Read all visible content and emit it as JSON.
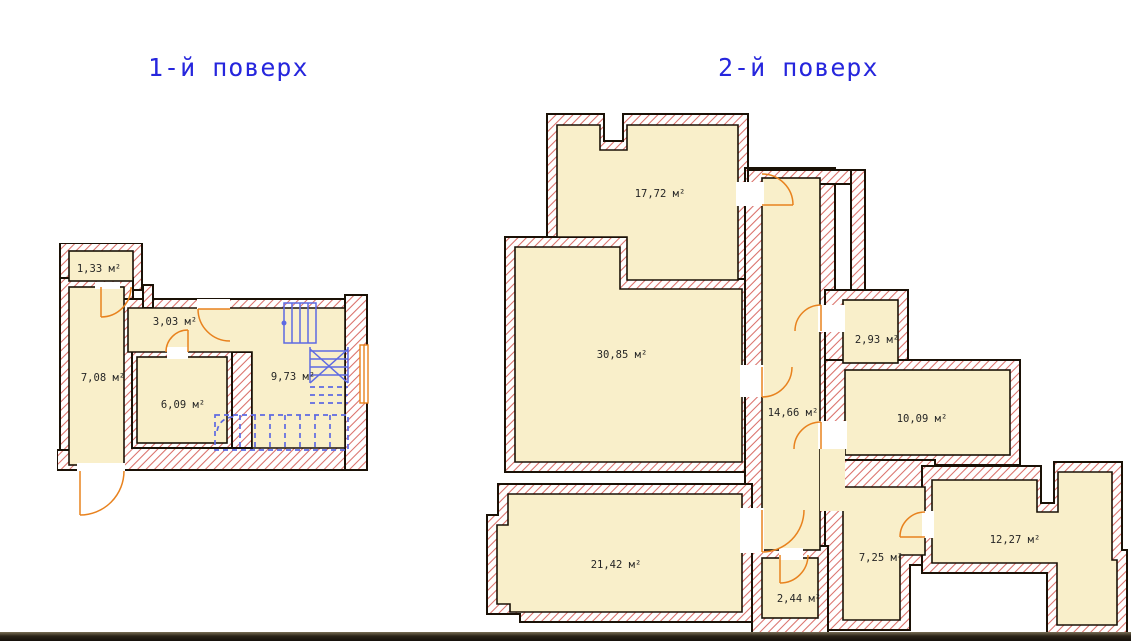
{
  "page": {
    "background_color": "#ffffff"
  },
  "plans": {
    "floor1": {
      "title": "1-й поверх",
      "rooms": [
        {
          "name": "room-1",
          "area_label": "1,33 м²"
        },
        {
          "name": "room-2",
          "area_label": "3,03 м²"
        },
        {
          "name": "room-3",
          "area_label": "7,08 м²"
        },
        {
          "name": "room-4",
          "area_label": "6,09 м²"
        },
        {
          "name": "room-5",
          "area_label": "9,73 м²"
        }
      ]
    },
    "floor2": {
      "title": "2-й поверх",
      "rooms": [
        {
          "name": "room-1",
          "area_label": "17,72 м²"
        },
        {
          "name": "room-2",
          "area_label": "30,85 м²"
        },
        {
          "name": "room-3",
          "area_label": "14,66 м²"
        },
        {
          "name": "room-4",
          "area_label": "2,93 м²"
        },
        {
          "name": "room-5",
          "area_label": "10,09 м²"
        },
        {
          "name": "room-6",
          "area_label": "21,42 м²"
        },
        {
          "name": "room-7",
          "area_label": "2,44 м²"
        },
        {
          "name": "room-8",
          "area_label": "7,25 м²"
        },
        {
          "name": "room-9",
          "area_label": "12,27 м²"
        }
      ]
    }
  },
  "colors": {
    "page_bg": "#ffffff",
    "room_fill": "#f9efca",
    "wall_hatch": "#d4564e",
    "wall_line": "#1a1106",
    "door_arc": "#e8821e",
    "window_frame": "#e8821e",
    "stair_lines": "#5e6ae2",
    "floor_title": "#2626dd",
    "scan_strip": "#241e14"
  }
}
